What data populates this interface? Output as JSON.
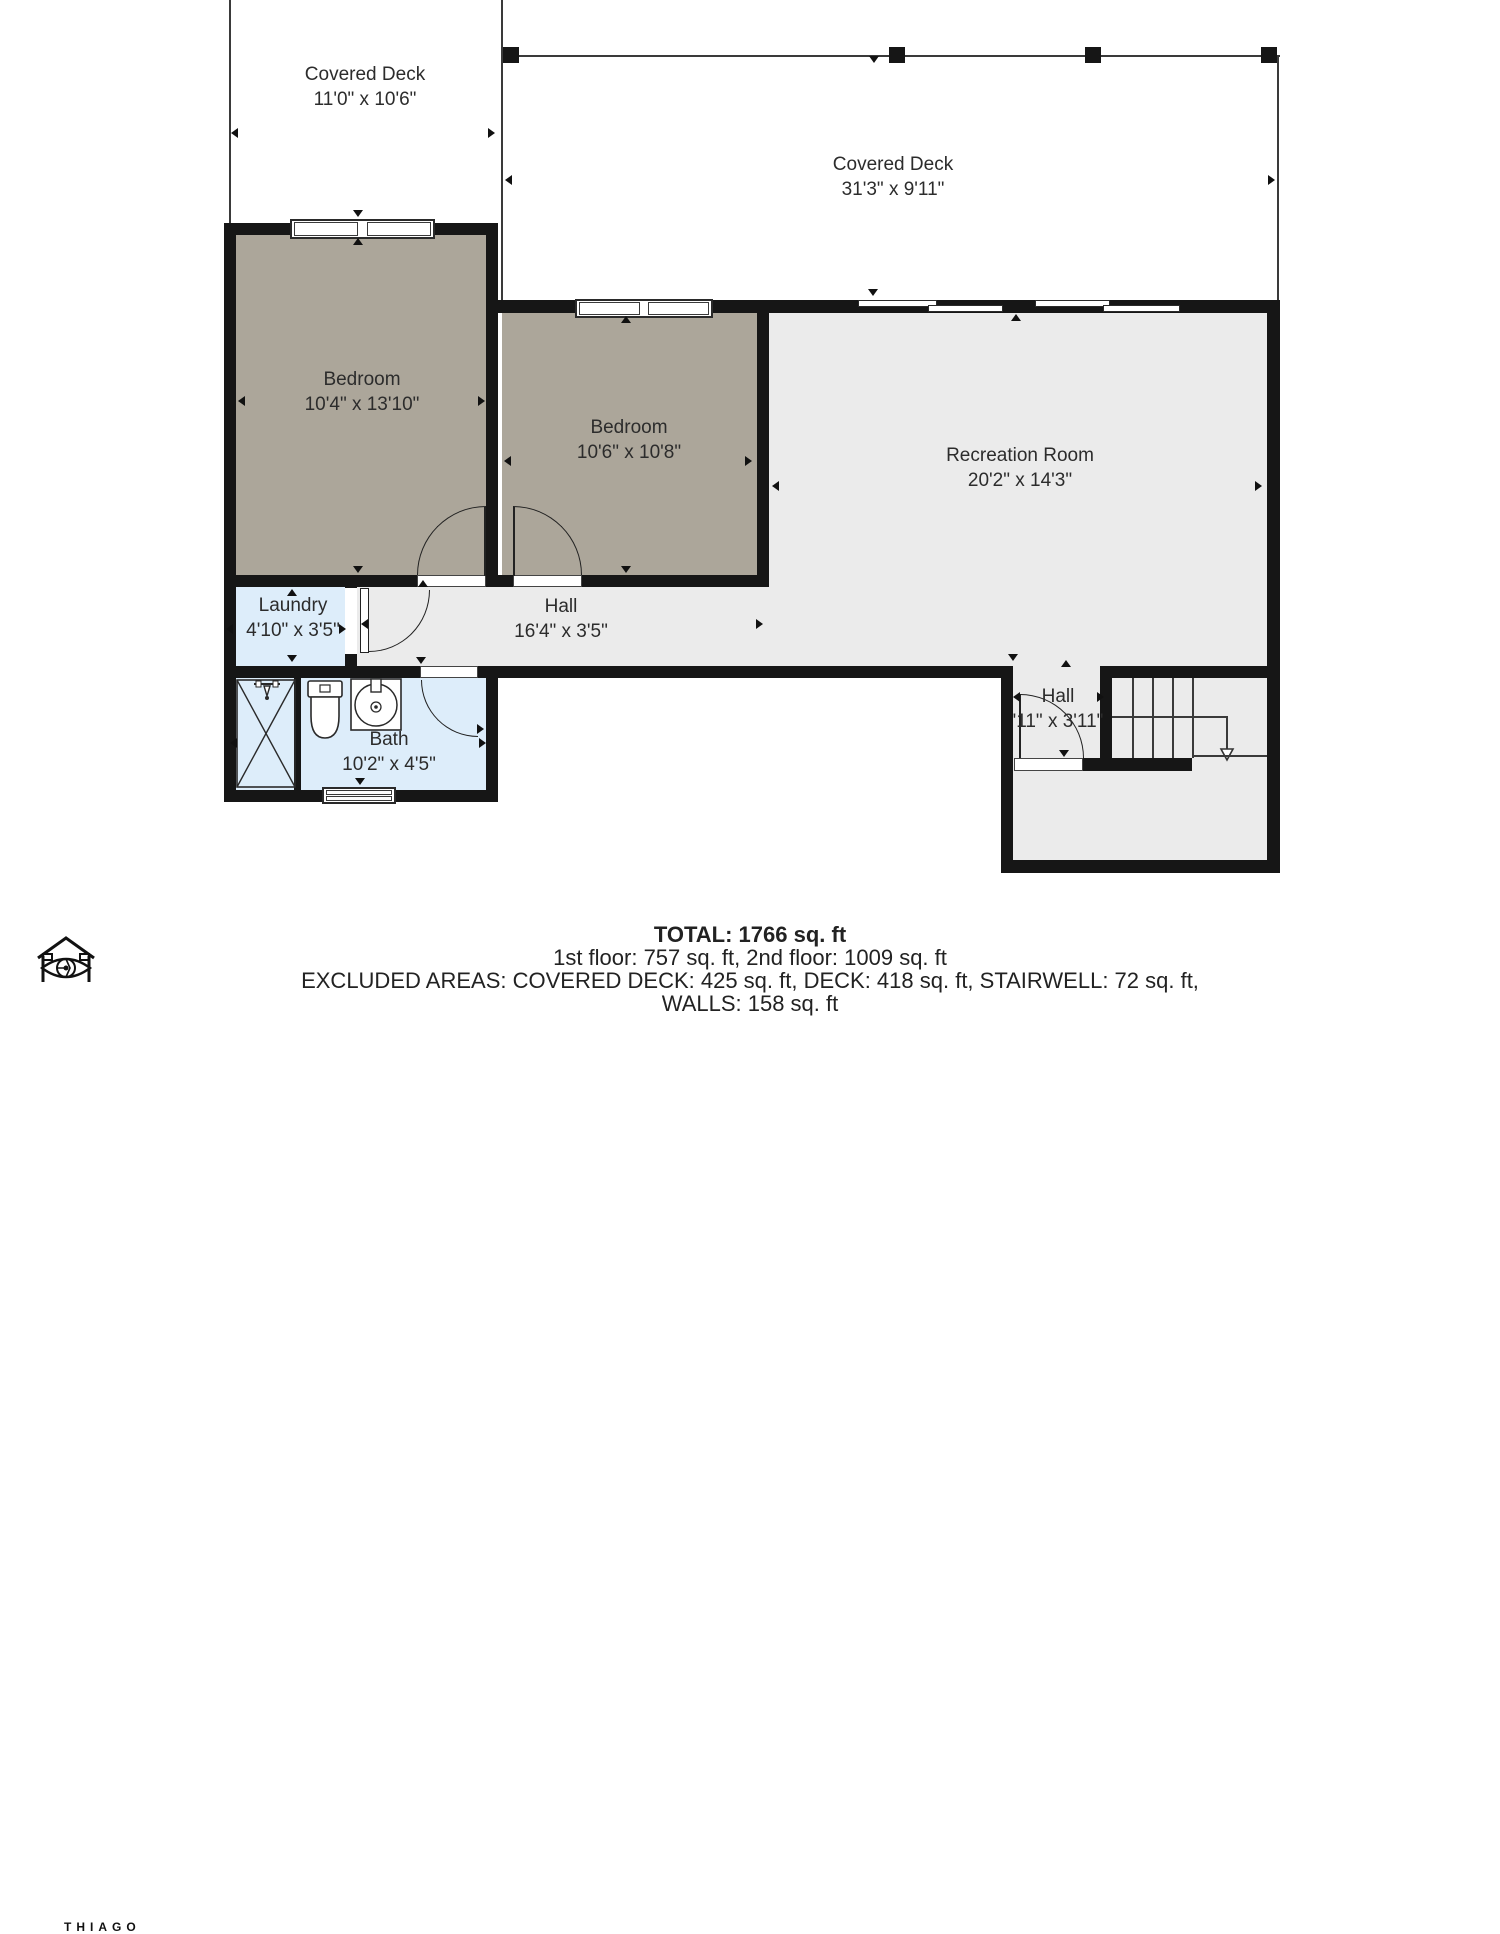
{
  "colors": {
    "wall": "#161616",
    "bedroom_fill": "#aca69a",
    "common_fill": "#ebebeb",
    "wet_fill": "#ddedfa",
    "line": "#3a3a3a",
    "label_text": "#2c2c2c"
  },
  "rooms": [
    {
      "id": "covered-deck-left",
      "label": "Covered Deck",
      "dims": "11'0\" x 10'6\""
    },
    {
      "id": "covered-deck-top",
      "label": "Covered Deck",
      "dims": "31'3\" x 9'11\""
    },
    {
      "id": "bedroom-1",
      "label": "Bedroom",
      "dims": "10'4\" x 13'10\""
    },
    {
      "id": "bedroom-2",
      "label": "Bedroom",
      "dims": "10'6\" x 10'8\""
    },
    {
      "id": "recreation-room",
      "label": "Recreation Room",
      "dims": "20'2\" x 14'3\""
    },
    {
      "id": "laundry",
      "label": "Laundry",
      "dims": "4'10\" x 3'5\""
    },
    {
      "id": "hall",
      "label": "Hall",
      "dims": "16'4\" x 3'5\""
    },
    {
      "id": "bath",
      "label": "Bath",
      "dims": "10'2\" x 4'5\""
    },
    {
      "id": "hall-2",
      "label": "Hall",
      "dims": "'11\" x 3'11\""
    }
  ],
  "footer": {
    "total": "TOTAL: 1766 sq. ft",
    "floors": "1st floor: 757 sq. ft, 2nd floor: 1009 sq. ft",
    "excluded1": "EXCLUDED AREAS: COVERED DECK: 425 sq. ft, DECK: 418 sq. ft, STAIRWELL: 72 sq. ft,",
    "excluded2": "WALLS: 158 sq. ft"
  },
  "logo": {
    "brand": "THIAGO"
  }
}
